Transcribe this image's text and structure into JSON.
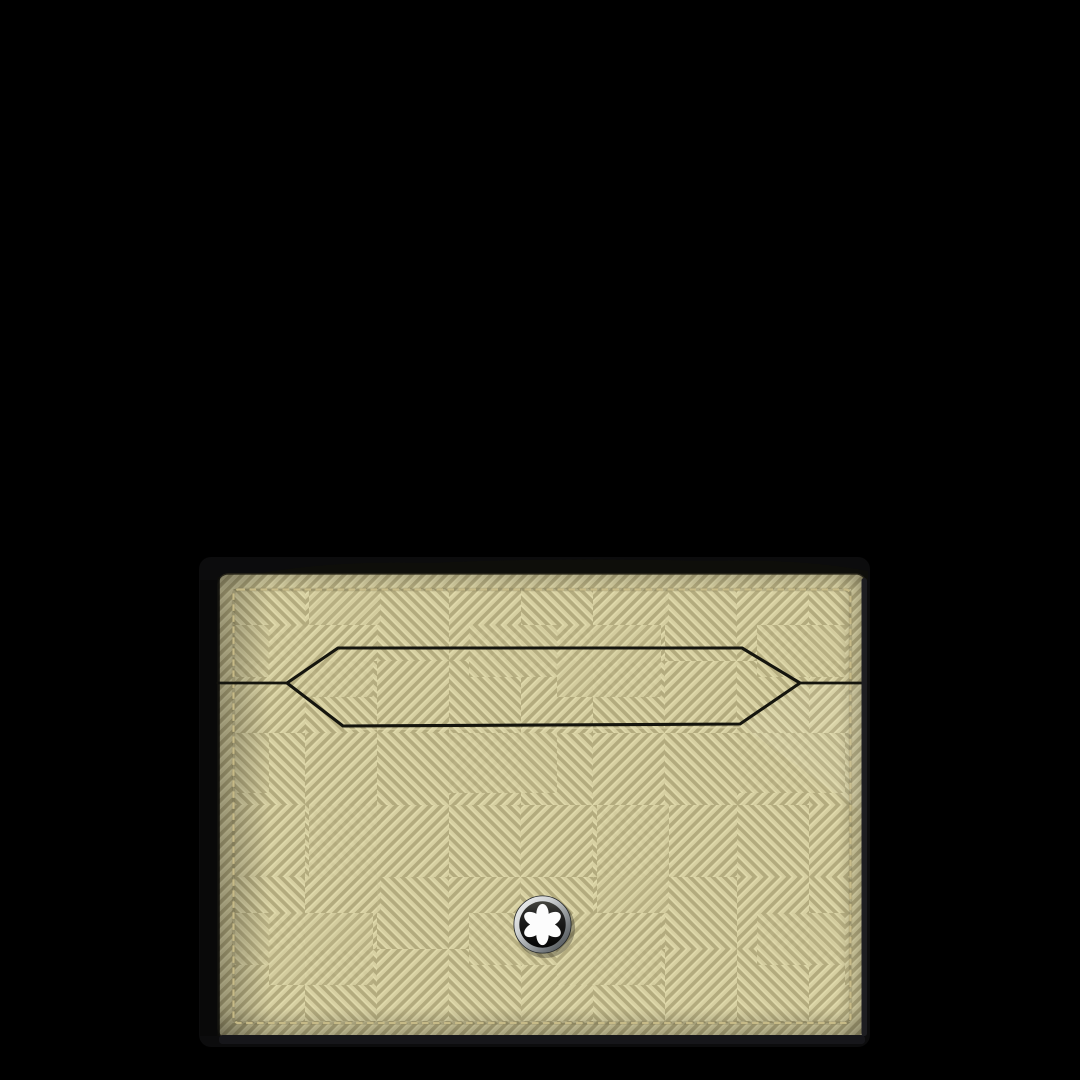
{
  "scene": {
    "background_color": "#000000",
    "product": {
      "kind_label": "card-holder-front-view",
      "leather": {
        "ridge_color": "#d7d0a2",
        "groove_color": "#b3ab7e",
        "crest_color": "#e2dcae"
      },
      "stitch_color": "#c9bd89",
      "slot_outline_color": "#15150e",
      "edge_color": "#16161a"
    },
    "emblem": {
      "icon": "montblanc-star-icon",
      "ring_color": "#cfd2d3",
      "face_color": "#141413",
      "star_color": "#fcfcfc"
    }
  }
}
